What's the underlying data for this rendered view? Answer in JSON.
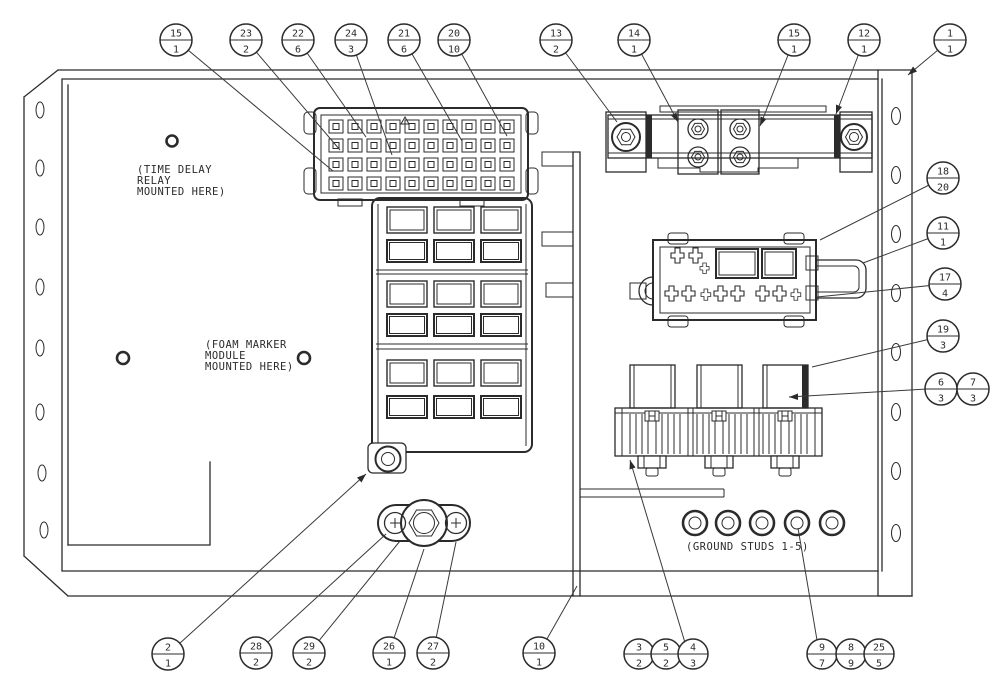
{
  "figure": {
    "background": "#ffffff",
    "line_color": "#2b2b2b",
    "description": "Electrical panel assembly parts diagram with numbered callout balloons (item number over quantity)"
  },
  "notes": {
    "time_delay": [
      "(TIME DELAY",
      "RELAY",
      "MOUNTED HERE)"
    ],
    "foam_marker": [
      "(FOAM MARKER",
      "MODULE",
      "MOUNTED HERE)"
    ],
    "ground_studs": "(GROUND STUDS 1-5)"
  },
  "callouts": [
    {
      "item": "15",
      "qty": "1"
    },
    {
      "item": "23",
      "qty": "2"
    },
    {
      "item": "22",
      "qty": "6"
    },
    {
      "item": "24",
      "qty": "3"
    },
    {
      "item": "21",
      "qty": "6"
    },
    {
      "item": "20",
      "qty": "10"
    },
    {
      "item": "13",
      "qty": "2"
    },
    {
      "item": "14",
      "qty": "1"
    },
    {
      "item": "15",
      "qty": "1"
    },
    {
      "item": "12",
      "qty": "1"
    },
    {
      "item": "1",
      "qty": "1"
    },
    {
      "item": "18",
      "qty": "20"
    },
    {
      "item": "11",
      "qty": "1"
    },
    {
      "item": "17",
      "qty": "4"
    },
    {
      "item": "19",
      "qty": "3"
    },
    {
      "item": "6",
      "qty": "3"
    },
    {
      "item": "7",
      "qty": "3"
    },
    {
      "item": "2",
      "qty": "1"
    },
    {
      "item": "28",
      "qty": "2"
    },
    {
      "item": "29",
      "qty": "2"
    },
    {
      "item": "26",
      "qty": "1"
    },
    {
      "item": "27",
      "qty": "2"
    },
    {
      "item": "10",
      "qty": "1"
    },
    {
      "item": "3",
      "qty": "2"
    },
    {
      "item": "5",
      "qty": "2"
    },
    {
      "item": "4",
      "qty": "3"
    },
    {
      "item": "9",
      "qty": "7"
    },
    {
      "item": "8",
      "qty": "9"
    },
    {
      "item": "25",
      "qty": "5"
    }
  ]
}
